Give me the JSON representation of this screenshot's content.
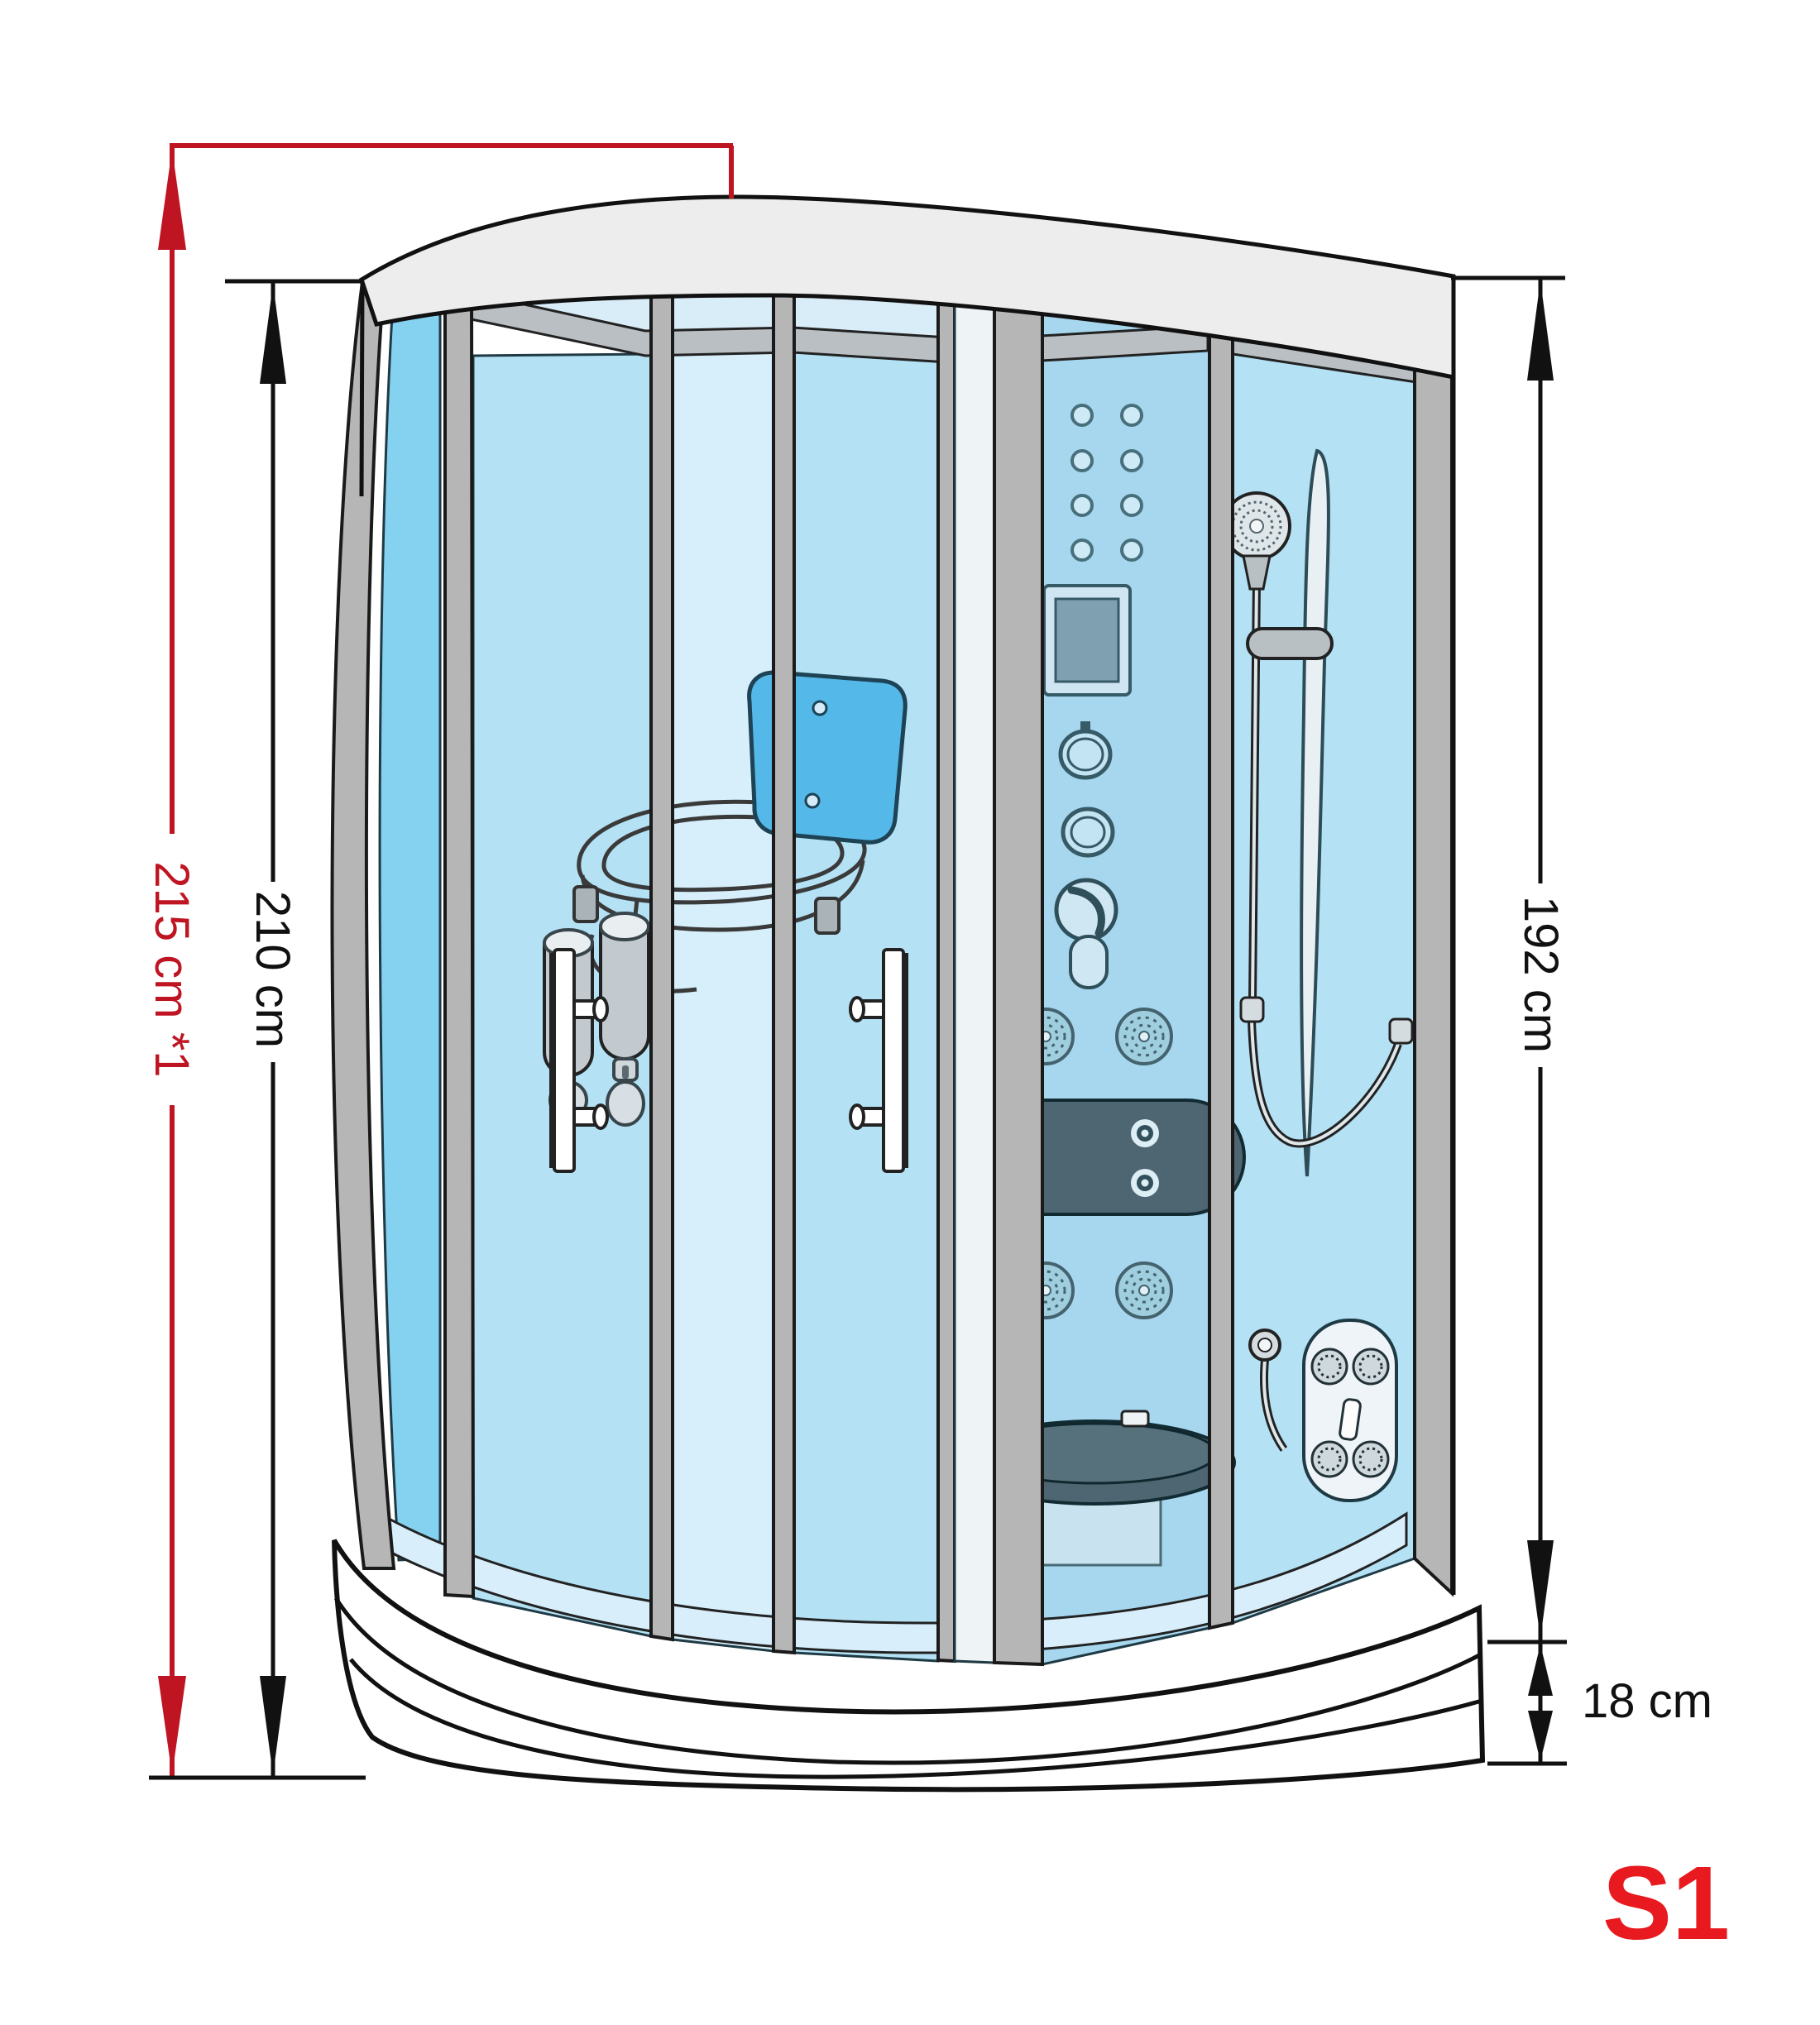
{
  "diagram": {
    "type": "product-dimension-diagram",
    "subject": "steam-shower-cabin-with-tray",
    "model_label": "S1",
    "dimensions": {
      "total_height": "215 cm *1",
      "cabin_height": "210 cm",
      "glass_height": "192 cm",
      "tray_height": "18 cm"
    },
    "colors": {
      "dimension_red": "#bf1522",
      "model_red": "#e8191f",
      "line_black": "#111111",
      "glass_blue": "#b4e1f4",
      "glass_cyan": "#85d1f0",
      "glass_pale": "#d6effb",
      "interior_blue": "#a6d7ee",
      "mirror_blue": "#54b8e8",
      "profile_gray": "#b6b6b6",
      "roof_gray": "#ededed",
      "dark_fixture": "#4e6572",
      "tray_white": "#ffffff"
    }
  }
}
